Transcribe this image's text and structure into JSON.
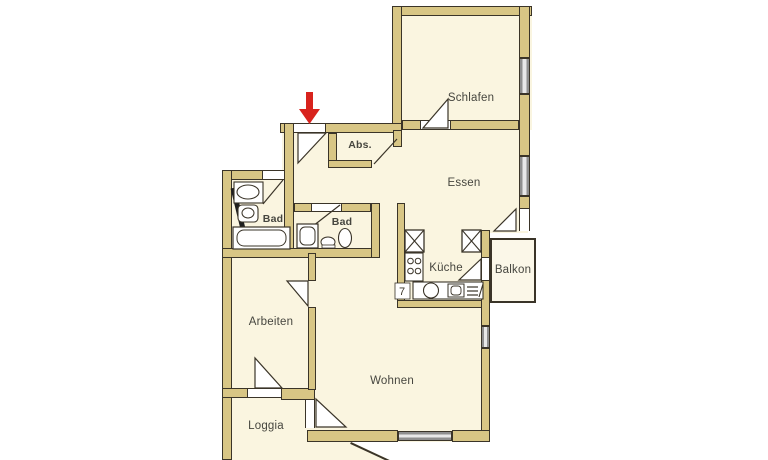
{
  "floorplan": {
    "rooms": {
      "schlafen": {
        "label": "Schlafen"
      },
      "essen": {
        "label": "Essen"
      },
      "abstellraum": {
        "label": "Abs."
      },
      "bad_1": {
        "label": "Bad"
      },
      "bad_2": {
        "label": "Bad"
      },
      "kueche": {
        "label": "Küche"
      },
      "balkon": {
        "label": "Balkon"
      },
      "arbeiten": {
        "label": "Arbeiten"
      },
      "wohnen": {
        "label": "Wohnen"
      },
      "loggia": {
        "label": "Loggia"
      }
    },
    "annotations": {
      "kitchen_number": "7"
    },
    "colors": {
      "wall_fill": "#d8c685",
      "wall_outline": "#3a3428",
      "floor": "#faf5e0",
      "window_fill": "#8f8f8f",
      "entrance_arrow": "#d8231d",
      "background": "#ffffff",
      "label_text": "#46463f"
    }
  }
}
